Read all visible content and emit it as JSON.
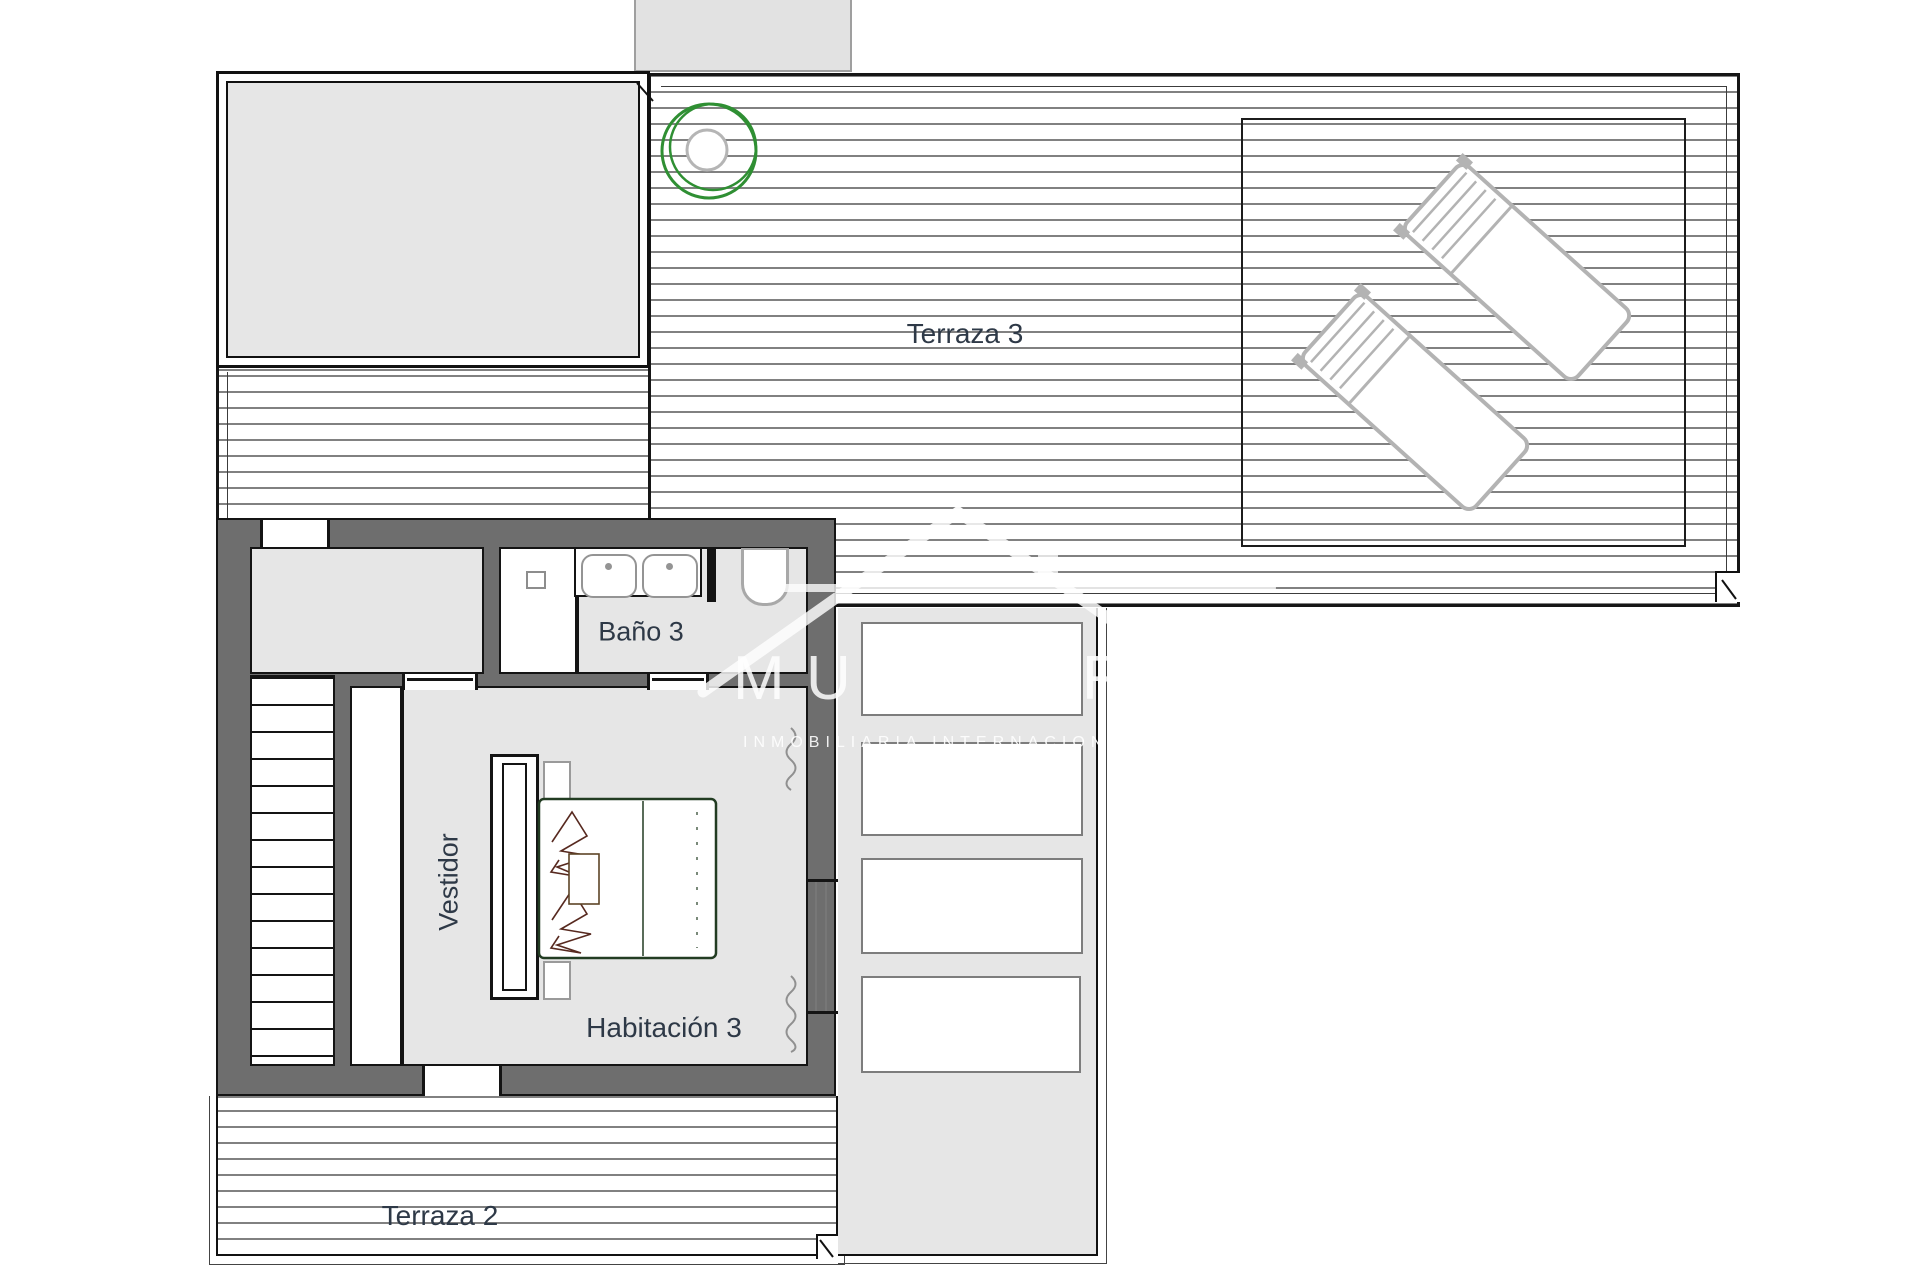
{
  "plan": {
    "type": "floor-plan",
    "rooms": {
      "terraza3": "Terraza 3",
      "terraza2": "Terraza 2",
      "bano3": "Baño 3",
      "habitacion3": "Habitación 3",
      "vestidor": "Vestidor"
    },
    "watermark": {
      "letters": [
        "M",
        "U",
        "R"
      ],
      "subtitle": "INMOBILIARIA  INTERNACIONAL"
    },
    "colors": {
      "wall_dark": "#6e6e6e",
      "outline_black": "#161616",
      "floor_gray": "#e6e6e6",
      "deck_line": "#818181",
      "fixture_gray": "#b3b3b3",
      "accent_green": "#2f8f33",
      "bed_outline_green": "#223c22",
      "pillow_sketch": "#57291f",
      "label_text": "#2e3947",
      "watermark_white": "#ffffff"
    }
  }
}
